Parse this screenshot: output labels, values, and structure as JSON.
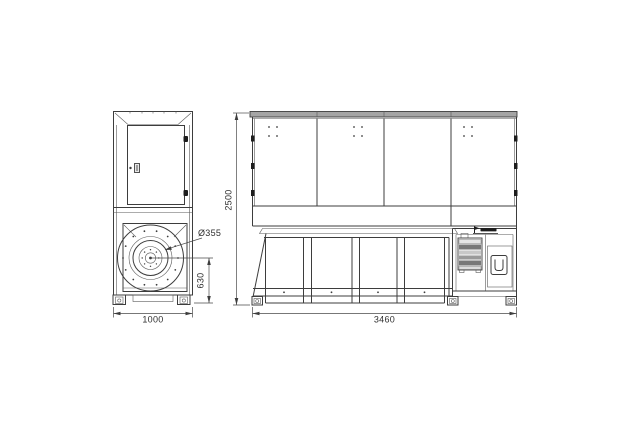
{
  "drawing": {
    "type": "technical-drawing",
    "views": {
      "side_view": {
        "dimensions": {
          "fan_inlet_diameter": "Ø355",
          "fan_center_to_base": "630",
          "base_width": "1000"
        }
      },
      "front_view": {
        "dimensions": {
          "overall_height": "2500",
          "overall_width": "3460"
        }
      }
    },
    "icons": {
      "brand_logo": "manufacturer-logo-mark"
    },
    "colors": {
      "background": "#ffffff",
      "line": "#3d3d3d",
      "roof_fill": "#a5a5a5",
      "hinge_fill": "#1d1d1d",
      "panel_row_dark": "#787878",
      "panel_row_mid": "#c8c8c8"
    }
  }
}
